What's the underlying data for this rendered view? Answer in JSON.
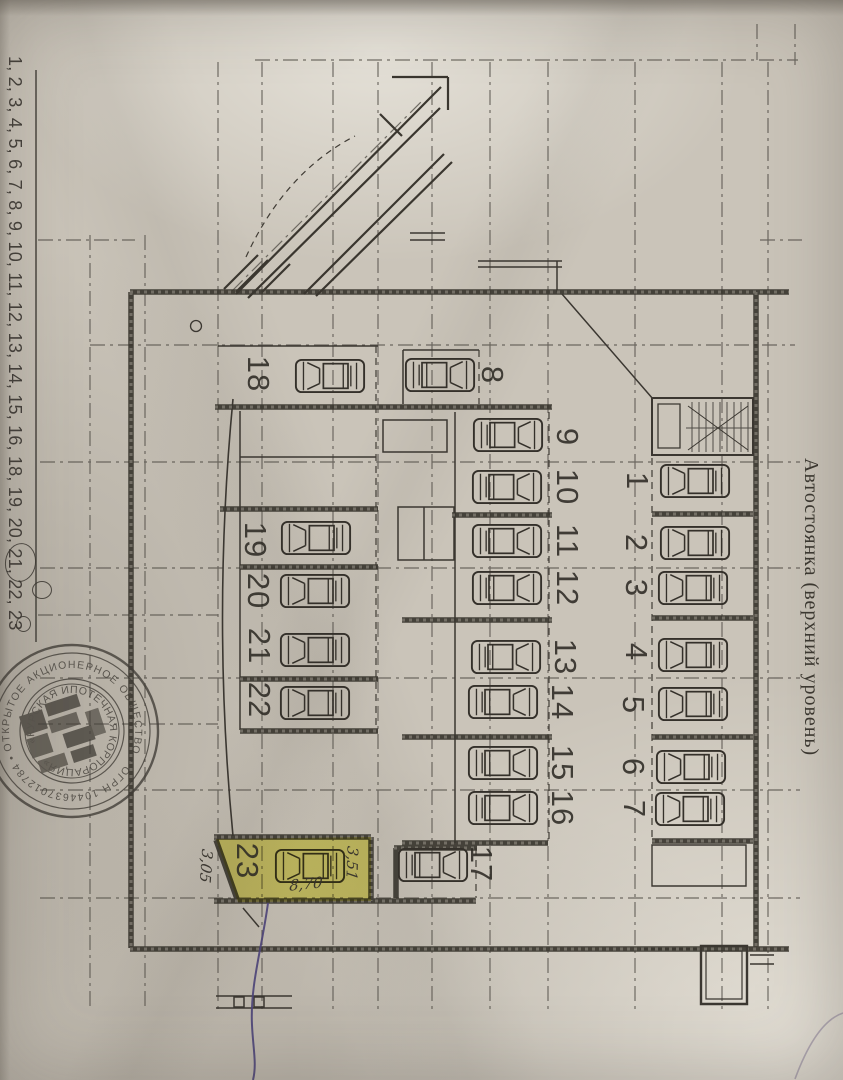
{
  "page": {
    "side_title": "Автостоянка (верхний уровень)",
    "margin_number_list": "1, 2, 3, 4, 5, 6, 7, 8, 9, 10, 11, 12, 13, 14, 15, 16, 18, 19, 20, 21, 22, 23",
    "highlight_color": "#ede93a",
    "pen_color": "#4b4377"
  },
  "stamp": {
    "outer_ring": "ОТКРЫТОЕ АКЦИОНЕРНОЕ ОБЩЕСТВО • ОГРН 1044637012784 •",
    "inner_ring": "«КУРСКАЯ ИПОТЕЧНАЯ КОРПОРАЦИЯ»"
  },
  "plan": {
    "highlighted_stall": "23",
    "dimensions": {
      "right": "3,51",
      "bottom": "8,70",
      "left": "3,05"
    },
    "icons": {
      "car": "top-view-car"
    },
    "stall_labels": {
      "s1": "1",
      "s2": "2",
      "s3": "3",
      "s4": "4",
      "s5": "5",
      "s6": "6",
      "s7": "7",
      "s8": "8",
      "s9": "9",
      "s10": "10",
      "s11": "11",
      "s12": "12",
      "s13": "13",
      "s14": "14",
      "s15": "15",
      "s16": "16",
      "s17": "17",
      "s18": "18",
      "s19": "19",
      "s20": "20",
      "s21": "21",
      "s22": "22",
      "s23": "23"
    }
  }
}
